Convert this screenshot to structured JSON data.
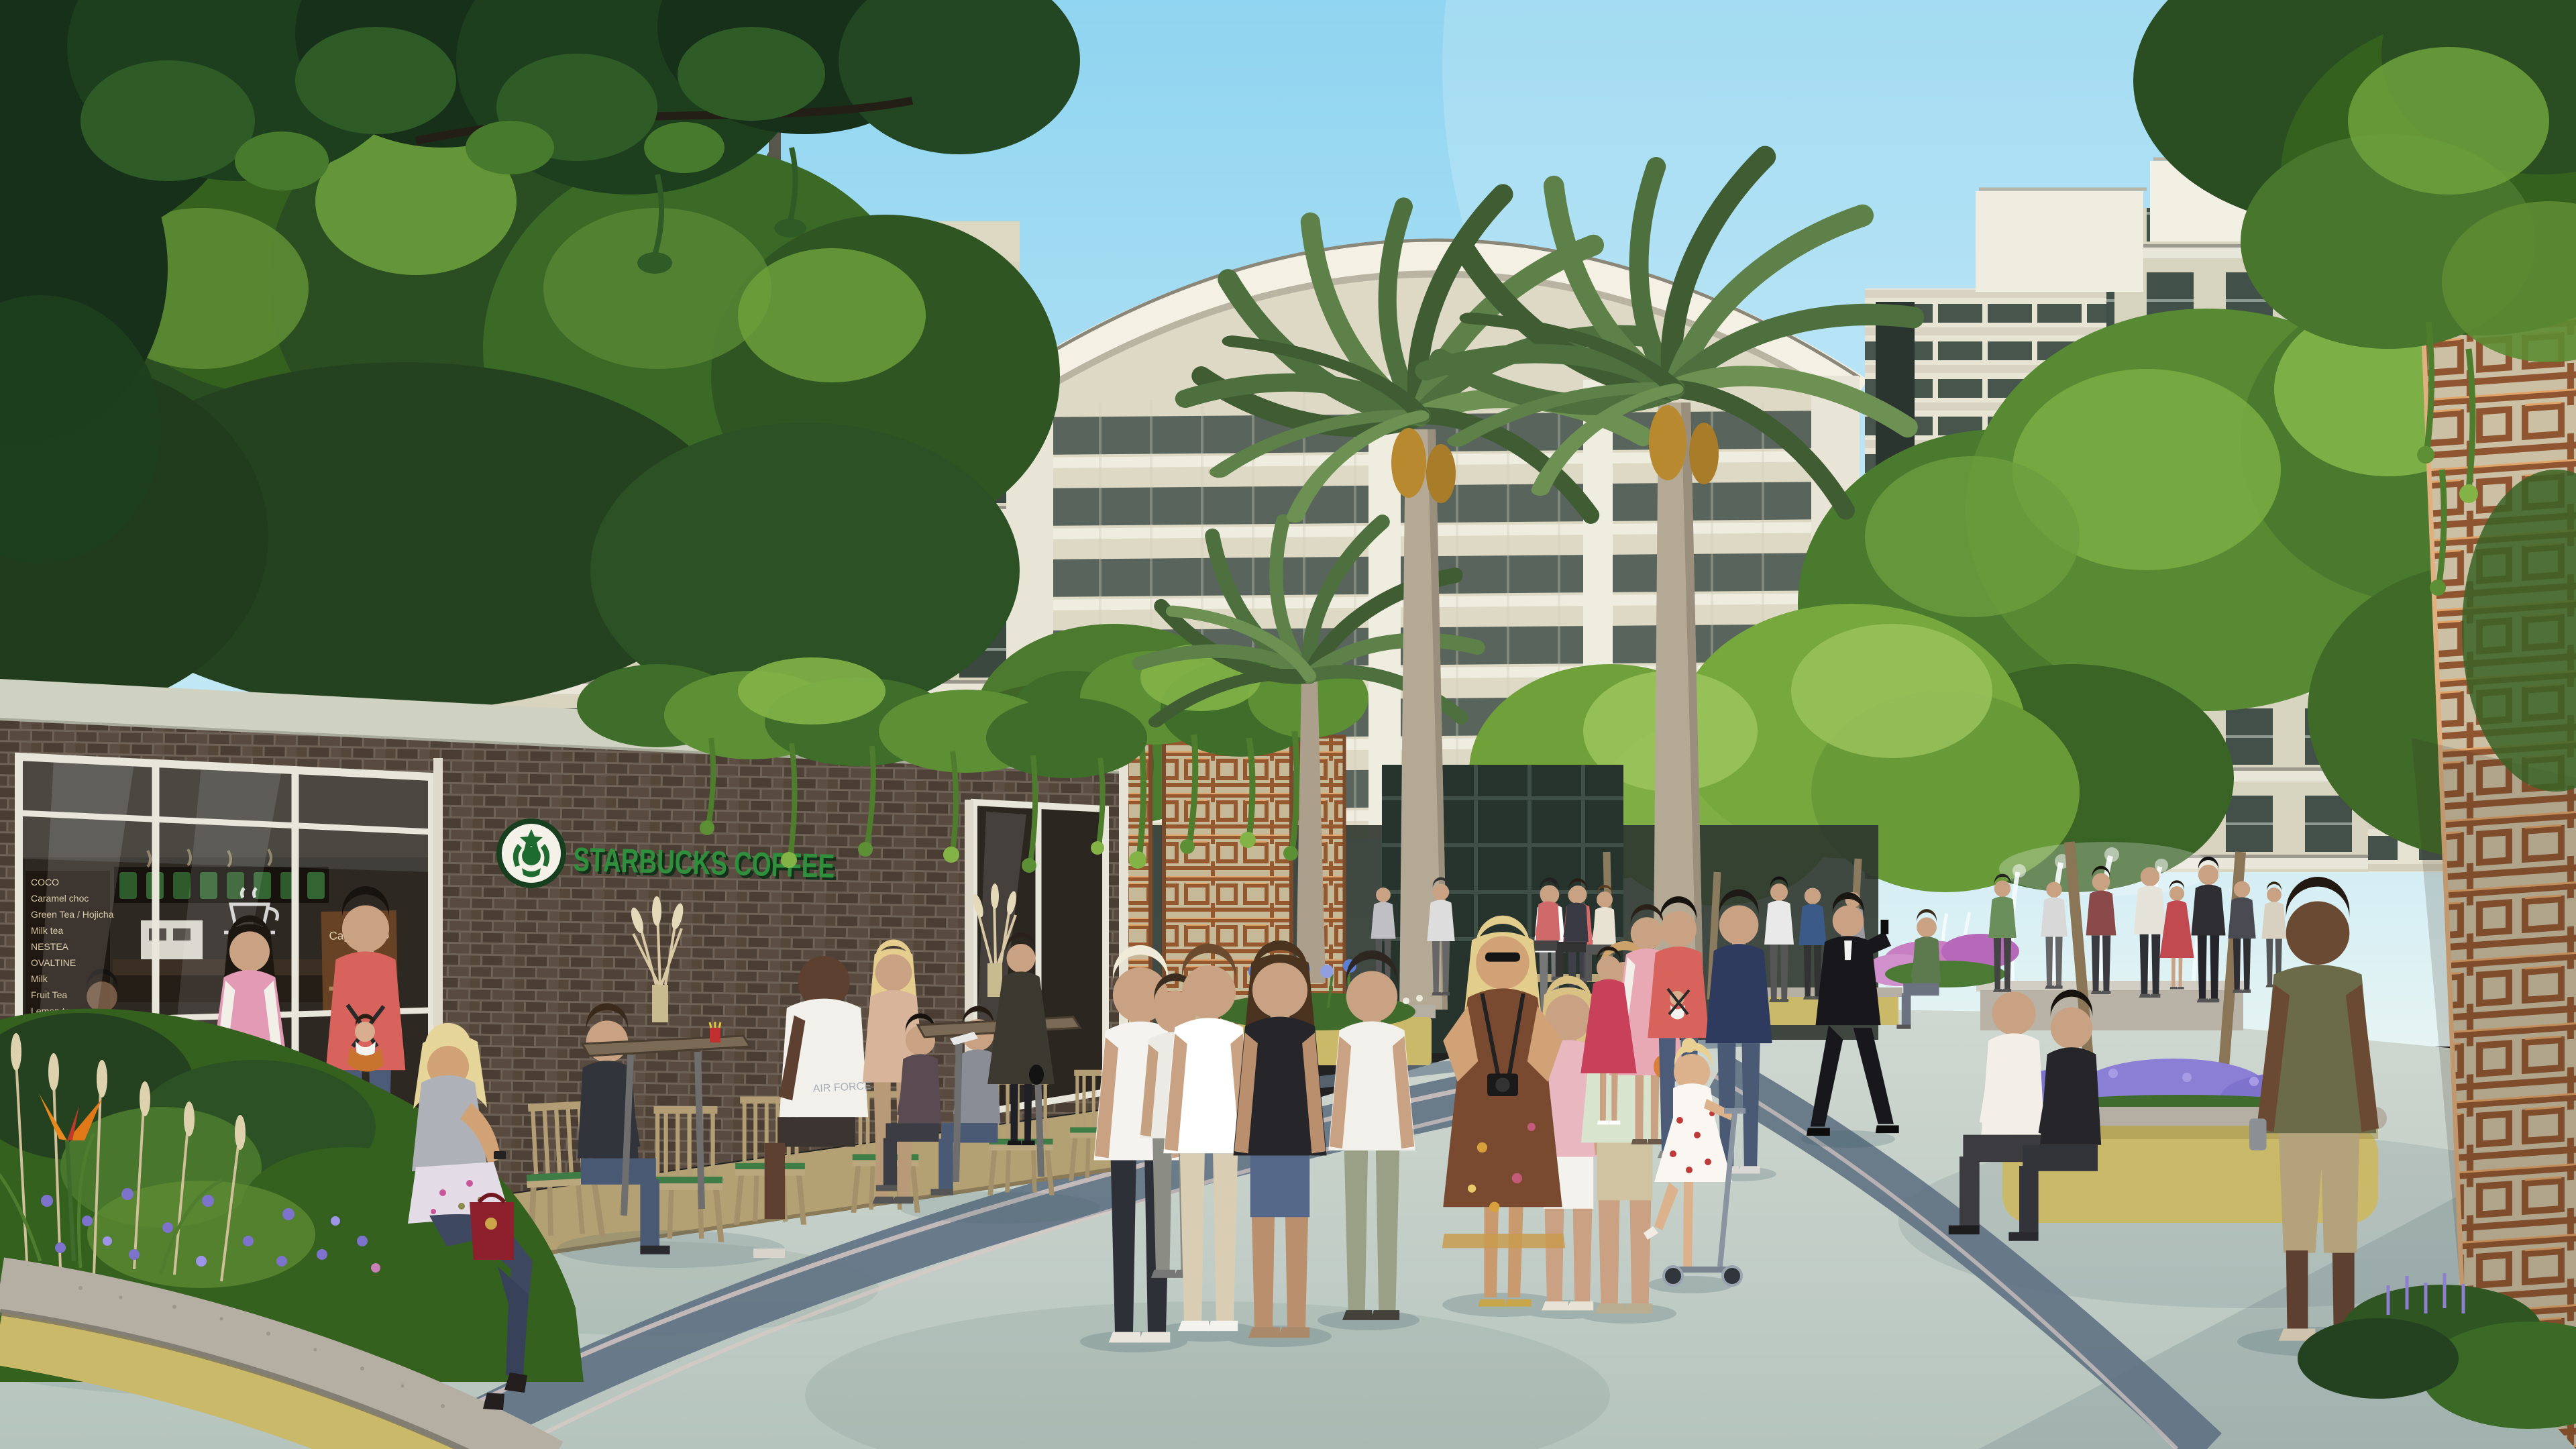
{
  "scene": {
    "setting": "Sunlit mixed-use retail promenade rendering with cafe, date palms, residential towers and pedestrians",
    "storefront": {
      "sign_text": "STARBUCKS COFFEE",
      "logo": "starbucks-siren-logo",
      "menu_board_items": [
        "COCO",
        "Caramel choc",
        "Green Tea / Hojicha",
        "Milk tea",
        "NESTEA",
        "OVALTINE",
        "Milk",
        "Fruit Tea",
        "Lemon tea"
      ],
      "window_poster_text": "Cappuccino",
      "tank_top_text": "AIR FORCE"
    },
    "palette": {
      "sky_top": "#8fd4f0",
      "sky_horizon": "#e6f4f3",
      "building_cream": "#d8d3bc",
      "building_white": "#eceadf",
      "glass_dark": "#3b4840",
      "brick": "#4e4238",
      "starbucks_green": "#2f8f3c",
      "copper_lattice": "#95582f",
      "foliage_dark": "#16301a",
      "foliage_mid": "#35611f",
      "foliage_light": "#83b347",
      "palm_frond": "#4e6f3e",
      "palm_trunk": "#b4a995",
      "pavement": "#c7d2cb",
      "pavement_band": "#5f7183",
      "planter_tile": "#c9b968",
      "granite_cap": "#b5afa3",
      "flower_purple": "#7d72cc",
      "flower_blue": "#5b7fd4",
      "fountain_white": "#f4fbfd"
    }
  }
}
